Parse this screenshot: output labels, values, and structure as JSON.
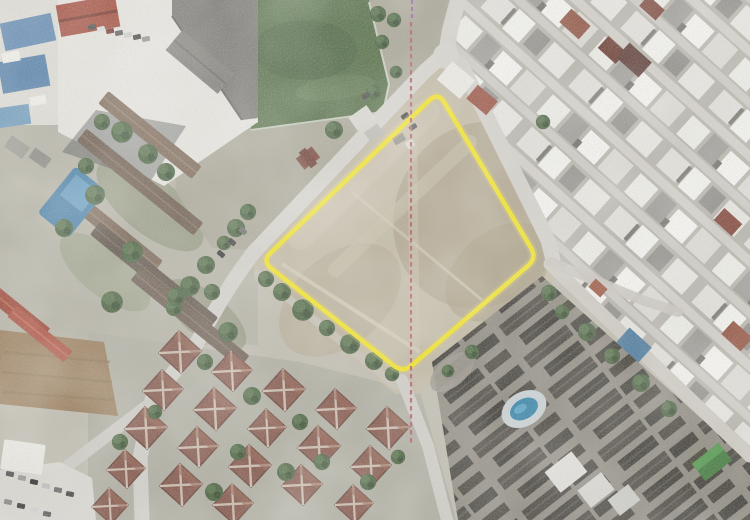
{
  "meta": {
    "kind": "scanned-aerial-photograph",
    "canvas": {
      "width": 750,
      "height": 520
    },
    "description_label": "aerial-photo"
  },
  "overlays": {
    "parcel_boundary": {
      "name": "subject-parcel-boundary",
      "color": "#f2e20a",
      "halo_color": "#d9c860",
      "stroke_width": "4.5",
      "halo_width": "9",
      "vertices_px": [
        [
          438,
          92
        ],
        [
          537,
          258
        ],
        [
          403,
          373
        ],
        [
          262,
          261
        ]
      ],
      "path": "M 270.7,252.7 L 429.3,100.3 Q 438,92 444.1,102.3 L 530.9,247.7 Q 537,258 527.9,265.8 L 412.1,365.2 Q 403,373 393.6,365.5 L 271.4,268.5 Q 262,261 270.7,252.7 Z"
    },
    "section_line": {
      "name": "survey-axis-dashed-line",
      "color": "#c2586c",
      "stroke_width": "2.2",
      "dash": "4.5 3.5",
      "path": "M 411,22 L 411,446"
    },
    "section_line_top": {
      "name": "survey-axis-dashed-line-top",
      "color": "#9a5fae",
      "stroke_width": "2.2",
      "dash": "4 3",
      "path": "M 412,0 L 412,20"
    }
  },
  "palette": {
    "bare_soil": "#c0b6a0",
    "scrub": "#a7a392",
    "sports_field_green": "#4e6b3e",
    "road_gray": "#d0cec7",
    "urban_roof_light": "#e9e8e3",
    "urban_roof_dark": "#4b4740",
    "villa_roof_red": "#875548",
    "pool_water_blue": "#2f86ae",
    "tree_green": "#45613b",
    "warehouse_red": "#a2402f",
    "school_roof_gray": "#74726c",
    "school_red_roof": "#a84736"
  },
  "features": [
    "sports-field",
    "school-complex",
    "vacant-parcel",
    "dense-urban-blocks-east",
    "villa-neighborhood-southwest",
    "dark-roof-housing-southeast",
    "left-residential-complex",
    "swimming-pools",
    "road-network",
    "tilled-field"
  ]
}
